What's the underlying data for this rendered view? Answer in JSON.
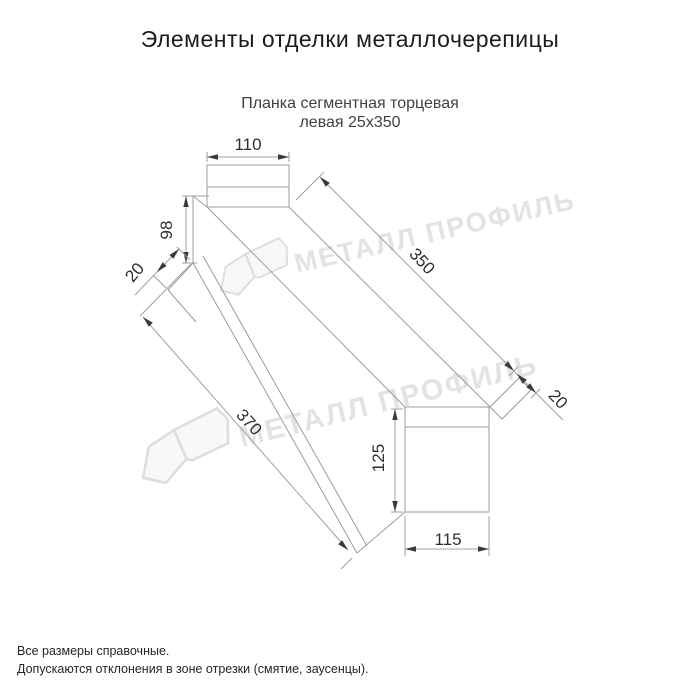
{
  "title": "Элементы отделки металлочерепицы",
  "subtitle": {
    "line1": "Планка сегментная торцевая",
    "line2": "левая 25х350"
  },
  "watermark": {
    "text": "МЕТАЛЛ ПРОФИЛЬ"
  },
  "dimensions": {
    "top_width": "110",
    "left_height": "98",
    "left_hem": "20",
    "length_top": "350",
    "right_hem": "20",
    "length_bottom": "370",
    "end_height": "125",
    "end_width": "115"
  },
  "footer": {
    "line1": "Все размеры справочные.",
    "line2": "Допускаются отклонения в зоне отрезки (смятие, заусенцы)."
  },
  "colors": {
    "line": "#9c9c9c",
    "dim_text": "#2e2e2e",
    "subtitle_text": "#473d3d",
    "watermark": "#e3e3e3"
  }
}
